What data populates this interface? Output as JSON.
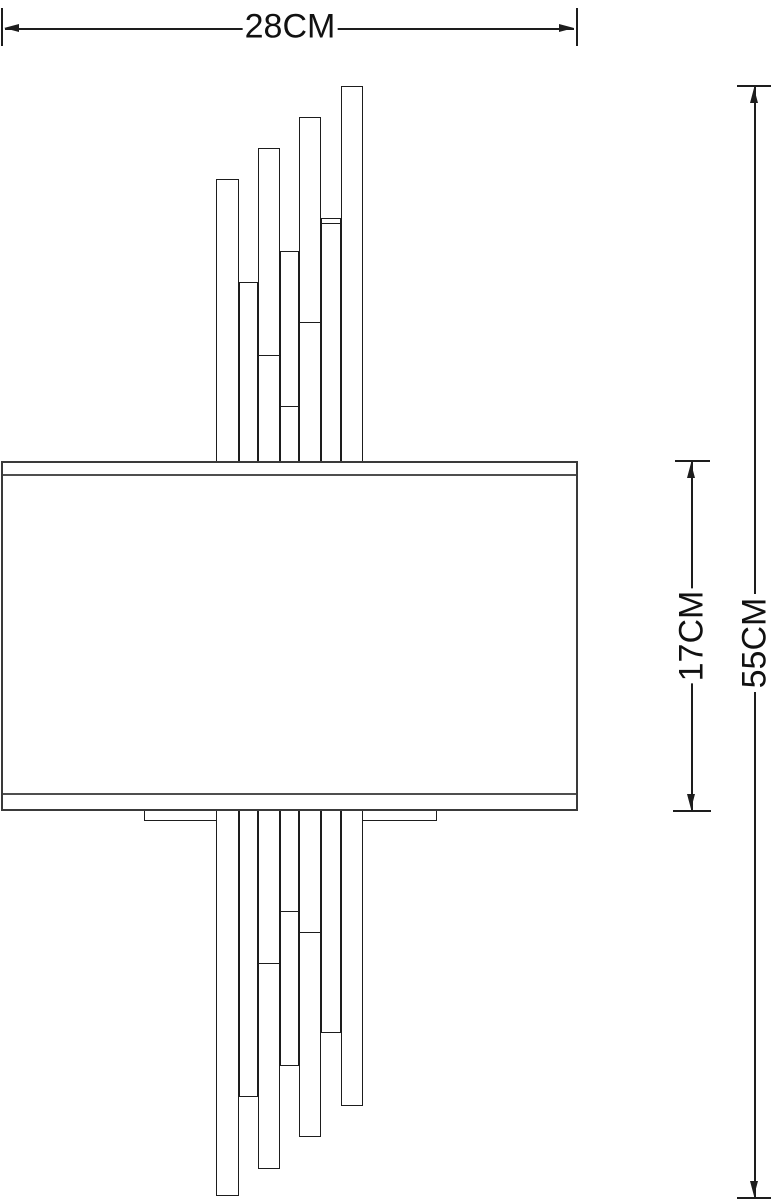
{
  "colors": {
    "background": "#ffffff",
    "line": "#1d1d1d",
    "shade_line": "#3a3a3a"
  },
  "dimensions": {
    "width": {
      "label": "28CM",
      "orientation": "horizontal"
    },
    "shade_height": {
      "label": "17CM",
      "orientation": "vertical"
    },
    "total_height": {
      "label": "55CM",
      "orientation": "vertical"
    }
  },
  "drawing": {
    "shade": {
      "left": 1,
      "top": 461,
      "width": 577,
      "height": 350,
      "band_top_offset": 11,
      "band_bottom_offset": 330
    },
    "backplate": {
      "left": 144,
      "top": 810,
      "width": 293,
      "height": 11
    },
    "rods": [
      {
        "left": 216,
        "width": 23,
        "top": 179,
        "bottom": 1196,
        "joints": []
      },
      {
        "left": 239,
        "width": 19,
        "top": 282,
        "bottom": 1097,
        "joints": []
      },
      {
        "left": 258,
        "width": 22,
        "top": 148,
        "bottom": 1169,
        "joints": [
          355,
          963
        ]
      },
      {
        "left": 280,
        "width": 19,
        "top": 251,
        "bottom": 1066,
        "joints": [
          406,
          911
        ]
      },
      {
        "left": 299,
        "width": 22,
        "top": 117,
        "bottom": 1137,
        "joints": [
          322,
          932
        ]
      },
      {
        "left": 321,
        "width": 20,
        "top": 218,
        "bottom": 1033,
        "joints": [
          223
        ]
      },
      {
        "left": 341,
        "width": 22,
        "top": 86,
        "bottom": 1106,
        "joints": []
      }
    ]
  }
}
